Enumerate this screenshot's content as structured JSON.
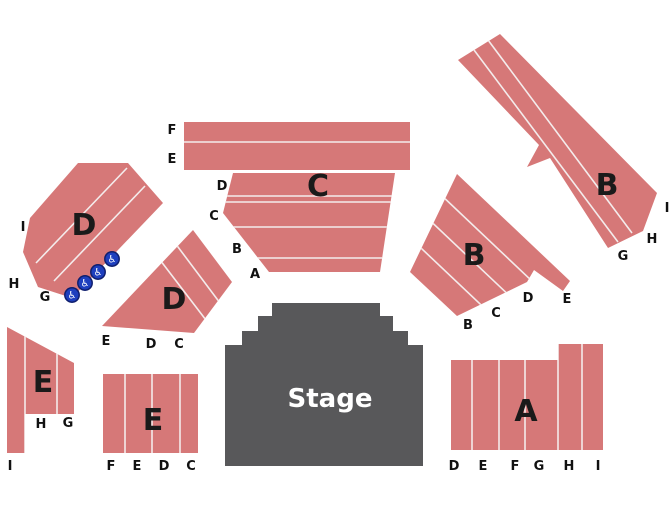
{
  "page": {
    "title": "Venue seating map",
    "background": "#ffffff"
  },
  "colors": {
    "section_fill": "#d67878",
    "row_line": "#f4ecec",
    "stage_fill": "#58585a",
    "stage_text": "#ffffff",
    "label_text": "#111111",
    "wheelchair_fill": "#1e3fbe",
    "wheelchair_ring": "#101f6e"
  },
  "stage": {
    "label": "Stage"
  },
  "sections": {
    "d_upper": {
      "label": "D",
      "row_labels": [
        "I",
        "H",
        "G"
      ]
    },
    "c": {
      "label": "C",
      "row_labels": [
        "F",
        "E",
        "D",
        "C",
        "B",
        "A"
      ]
    },
    "d_lower": {
      "label": "D",
      "row_labels": [
        "E",
        "D",
        "C"
      ]
    },
    "b_mid": {
      "label": "B",
      "row_labels": [
        "B",
        "C",
        "D",
        "E"
      ]
    },
    "b_diag": {
      "label": "B",
      "row_labels": [
        "I",
        "H",
        "G"
      ]
    },
    "e_left": {
      "label": "E",
      "row_labels": [
        "H",
        "G",
        "I"
      ]
    },
    "e_bottom": {
      "label": "E",
      "row_labels": [
        "F",
        "E",
        "D",
        "C"
      ]
    },
    "a": {
      "label": "A",
      "row_labels": [
        "D",
        "E",
        "F",
        "G",
        "H",
        "I"
      ]
    }
  },
  "wheelchair_icons": {
    "glyph": "♿",
    "count": 4
  }
}
